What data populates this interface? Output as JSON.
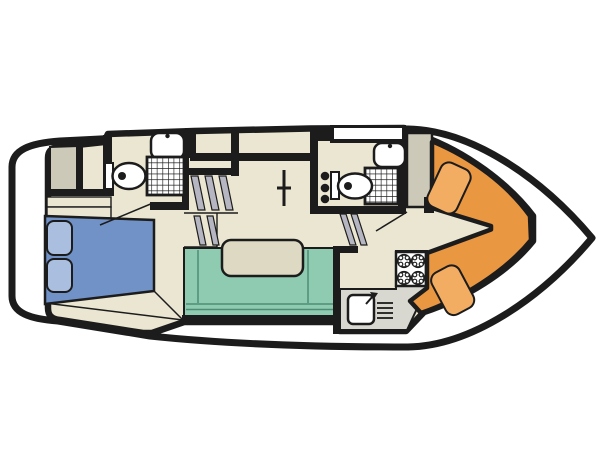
{
  "diagram": {
    "type": "boat-floor-plan",
    "description": "Top-down interior deck plan of a motor cruiser, bow pointing right",
    "rooms": [
      {
        "id": "aft-cabin",
        "features": [
          "double-bed",
          "two-pillows",
          "wardrobe",
          "shelves"
        ]
      },
      {
        "id": "aft-bathroom",
        "features": [
          "toilet",
          "shower",
          "washbasin"
        ]
      },
      {
        "id": "companionway-stairs",
        "features": [
          "steps"
        ]
      },
      {
        "id": "saloon",
        "features": [
          "u-shaped-sofa",
          "table"
        ]
      },
      {
        "id": "galley",
        "features": [
          "four-burner-stove",
          "sink-with-drainer",
          "counter"
        ]
      },
      {
        "id": "forward-bathroom",
        "features": [
          "toilet",
          "shower",
          "washbasin",
          "wall-hooks",
          "roof-hatch"
        ]
      },
      {
        "id": "forward-wardrobe",
        "features": [
          "cabinet"
        ]
      },
      {
        "id": "bow-cockpit",
        "features": [
          "v-shaped-seating",
          "two-cushions"
        ]
      }
    ]
  },
  "colors": {
    "outline": "#1c1c1c",
    "hull": "#ffffff",
    "floor": "#eae6d1",
    "wardrobe": "#cdc9b9",
    "counter": "#d9d8d0",
    "bed": "#7092c7",
    "pillow": "#aabfe0",
    "sofa": "#8ecbb1",
    "sofa_line": "#4e8c76",
    "table": "#ddd9c3",
    "bow_seat": "#ea9742",
    "bow_cushion": "#f2ad62",
    "stair_shade": "#b6b6c2",
    "fixture": "#ffffff"
  }
}
